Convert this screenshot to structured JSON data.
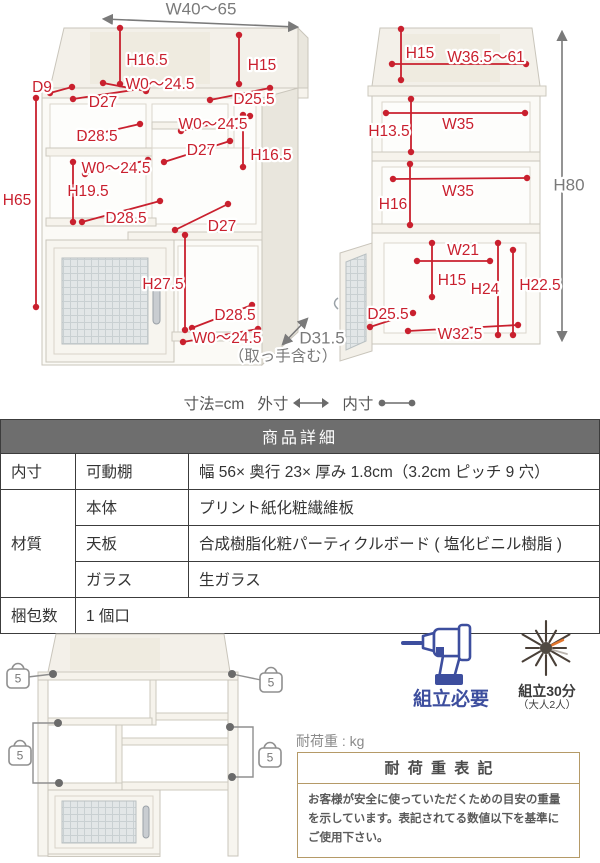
{
  "colors": {
    "dimension_red": "#c9202e",
    "annotation_gray": "#7a7a7a",
    "assembly_navy": "#3d4e9e",
    "load_box_border": "#b59a67",
    "table_header_bg": "#6e6e6e"
  },
  "legend": {
    "unit": "寸法=cm",
    "outer": "外寸",
    "inner": "内寸"
  },
  "diagram_left": {
    "width_label": "W40〜65",
    "depth_label": "D31.5",
    "depth_note": "（取っ手含む）",
    "labels": [
      {
        "t": "H16.5",
        "x": 147,
        "y": 61
      },
      {
        "t": "H15",
        "x": 262,
        "y": 66
      },
      {
        "t": "D9",
        "x": 42,
        "y": 88
      },
      {
        "t": "W0〜24.5",
        "x": 160,
        "y": 85
      },
      {
        "t": "D27",
        "x": 103,
        "y": 103
      },
      {
        "t": "D25.5",
        "x": 254,
        "y": 100
      },
      {
        "t": "D28.5",
        "x": 97,
        "y": 137
      },
      {
        "t": "W0〜24.5",
        "x": 213,
        "y": 125
      },
      {
        "t": "D27",
        "x": 201,
        "y": 151
      },
      {
        "t": "H16.5",
        "x": 271,
        "y": 156
      },
      {
        "t": "W0〜24.5",
        "x": 116,
        "y": 169
      },
      {
        "t": "H19.5",
        "x": 88,
        "y": 192
      },
      {
        "t": "H65",
        "x": 17,
        "y": 201
      },
      {
        "t": "D28.5",
        "x": 126,
        "y": 219
      },
      {
        "t": "D27",
        "x": 222,
        "y": 227
      },
      {
        "t": "H27.5",
        "x": 163,
        "y": 285
      },
      {
        "t": "D28.5",
        "x": 235,
        "y": 316
      },
      {
        "t": "W0〜24.5",
        "x": 227,
        "y": 339
      }
    ],
    "lines": [
      [
        120,
        28,
        120,
        84
      ],
      [
        239,
        35,
        239,
        84
      ],
      [
        50,
        93,
        72,
        87
      ],
      [
        103,
        83,
        146,
        91
      ],
      [
        73,
        99,
        147,
        88
      ],
      [
        210,
        100,
        270,
        88
      ],
      [
        79,
        138,
        140,
        124
      ],
      [
        181,
        131,
        250,
        116
      ],
      [
        164,
        162,
        230,
        141
      ],
      [
        243,
        115,
        243,
        167
      ],
      [
        85,
        174,
        148,
        160
      ],
      [
        73,
        162,
        73,
        222
      ],
      [
        36,
        98,
        36,
        307
      ],
      [
        82,
        222,
        160,
        201
      ],
      [
        175,
        230,
        228,
        204
      ],
      [
        185,
        235,
        185,
        330
      ],
      [
        192,
        328,
        252,
        305
      ],
      [
        183,
        342,
        258,
        329
      ]
    ]
  },
  "diagram_right": {
    "height_label": "H80",
    "labels": [
      {
        "t": "H15",
        "x": 420,
        "y": 54
      },
      {
        "t": "W36.5〜61",
        "x": 486,
        "y": 58
      },
      {
        "t": "H13.5",
        "x": 389,
        "y": 132
      },
      {
        "t": "W35",
        "x": 458,
        "y": 125
      },
      {
        "t": "W35",
        "x": 458,
        "y": 192
      },
      {
        "t": "H16",
        "x": 393,
        "y": 205
      },
      {
        "t": "W21",
        "x": 463,
        "y": 251
      },
      {
        "t": "H15",
        "x": 452,
        "y": 281
      },
      {
        "t": "H24",
        "x": 485,
        "y": 290
      },
      {
        "t": "H22.5",
        "x": 540,
        "y": 286
      },
      {
        "t": "D25.5",
        "x": 388,
        "y": 315
      },
      {
        "t": "W32.5",
        "x": 460,
        "y": 335
      }
    ],
    "lines": [
      [
        401,
        29,
        401,
        80
      ],
      [
        392,
        64,
        526,
        64
      ],
      [
        386,
        113,
        525,
        113
      ],
      [
        411,
        99,
        411,
        152
      ],
      [
        393,
        179,
        527,
        178
      ],
      [
        410,
        164,
        410,
        225
      ],
      [
        417,
        261,
        490,
        261
      ],
      [
        432,
        243,
        432,
        297
      ],
      [
        498,
        243,
        498,
        335
      ],
      [
        513,
        250,
        513,
        335
      ],
      [
        370,
        327,
        413,
        313
      ],
      [
        408,
        331,
        518,
        325
      ]
    ]
  },
  "table": {
    "title": "商品詳細",
    "r1c1": "内寸",
    "r1c2": "可動棚",
    "r1c3": "幅 56× 奥行 23× 厚み 1.8cm（3.2cm ピッチ 9 穴）",
    "mat": "材質",
    "r2c2": "本体",
    "r2c3": "プリント紙化粧繊維板",
    "r3c2": "天板",
    "r3c3": "合成樹脂化粧パーティクルボード ( 塩化ビニル樹脂 )",
    "r4c2": "ガラス",
    "r4c3": "生ガラス",
    "r5c1": "梱包数",
    "r5c2": "1 個口"
  },
  "assembly": {
    "required": "組立必要",
    "time": "組立30分",
    "people": "（大人2人）"
  },
  "load": {
    "caption": "耐荷重 : kg",
    "box_title": "耐荷重表記",
    "box_text": "お客様が安全に使っていただくための目安の重量を示しています。表記されてる数値以下を基準にご使用下さい。"
  },
  "weights": {
    "value": "5",
    "positions": [
      [
        18,
        60
      ],
      [
        271,
        64
      ],
      [
        20,
        137
      ],
      [
        270,
        139
      ]
    ]
  }
}
